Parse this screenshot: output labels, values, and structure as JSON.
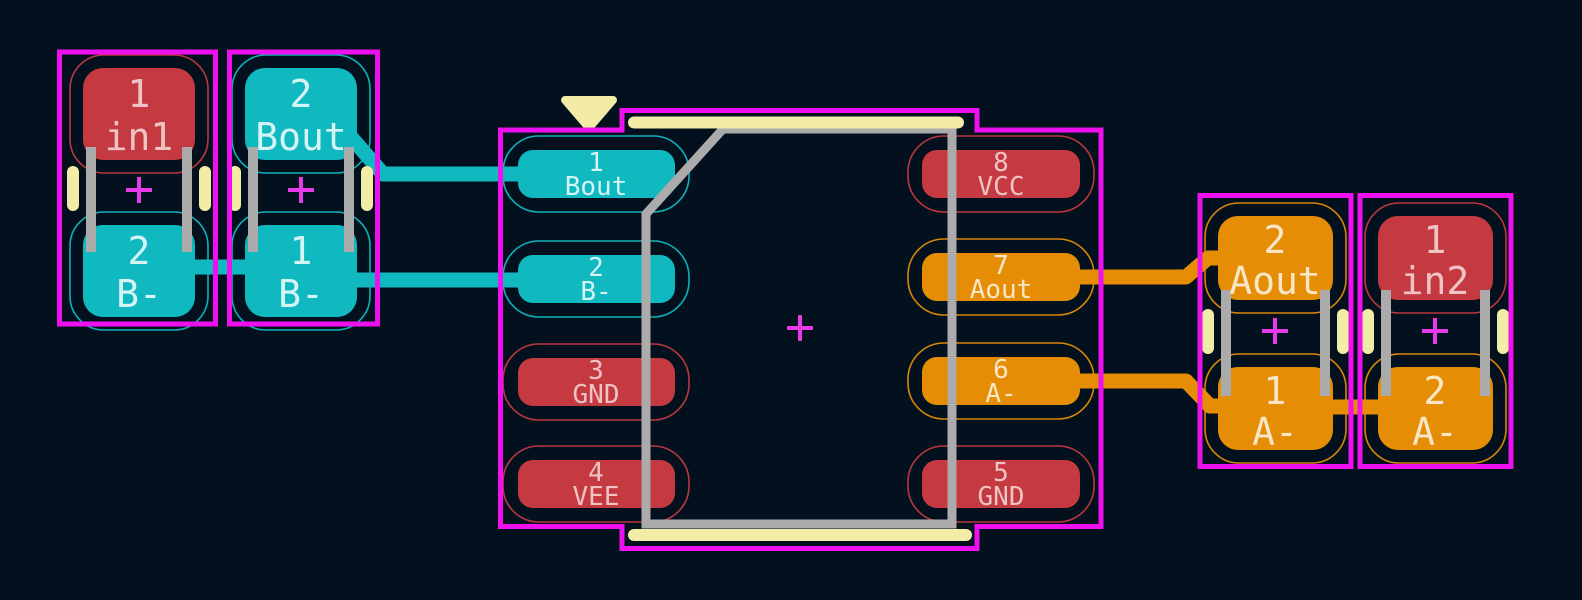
{
  "canvas": {
    "width_px": 1582,
    "height_px": 600,
    "background": "#03111f",
    "view": "pcb-layout-editor-canvas"
  },
  "palette": {
    "pad_red": "#c43a40",
    "pad_cyan": "#10b9c0",
    "pad_orange": "#e58d04",
    "trace_cyan": "#10b9c0",
    "trace_orange": "#e58d04",
    "courtyard_magenta": "#ee10ee",
    "silkscreen_yellow": "#f2eca6",
    "fab_gray": "#ababab",
    "anchor_cross_magenta": "#e838e8",
    "text_on_red": "#efc3c4",
    "text_on_cyan": "#d4f4f5",
    "text_on_orange": "#f8e6c6"
  },
  "nets": [
    "in1",
    "in2",
    "Bout",
    "Aout",
    "B-",
    "A-",
    "GND",
    "VEE",
    "VCC"
  ],
  "components": [
    {
      "label": "passive-left-1",
      "pads": [
        {
          "number": "1",
          "net": "in1"
        },
        {
          "number": "2",
          "net": "B-"
        }
      ]
    },
    {
      "label": "passive-left-2",
      "pads": [
        {
          "number": "2",
          "net": "Bout"
        },
        {
          "number": "1",
          "net": "B-"
        }
      ]
    },
    {
      "label": "soic8-ic",
      "pads": [
        {
          "number": "1",
          "net": "Bout"
        },
        {
          "number": "2",
          "net": "B-"
        },
        {
          "number": "3",
          "net": "GND"
        },
        {
          "number": "4",
          "net": "VEE"
        },
        {
          "number": "5",
          "net": "GND"
        },
        {
          "number": "6",
          "net": "A-"
        },
        {
          "number": "7",
          "net": "Aout"
        },
        {
          "number": "8",
          "net": "VCC"
        }
      ]
    },
    {
      "label": "passive-right-1",
      "pads": [
        {
          "number": "2",
          "net": "Aout"
        },
        {
          "number": "1",
          "net": "A-"
        }
      ]
    },
    {
      "label": "passive-right-2",
      "pads": [
        {
          "number": "1",
          "net": "in2"
        },
        {
          "number": "2",
          "net": "A-"
        }
      ]
    }
  ]
}
